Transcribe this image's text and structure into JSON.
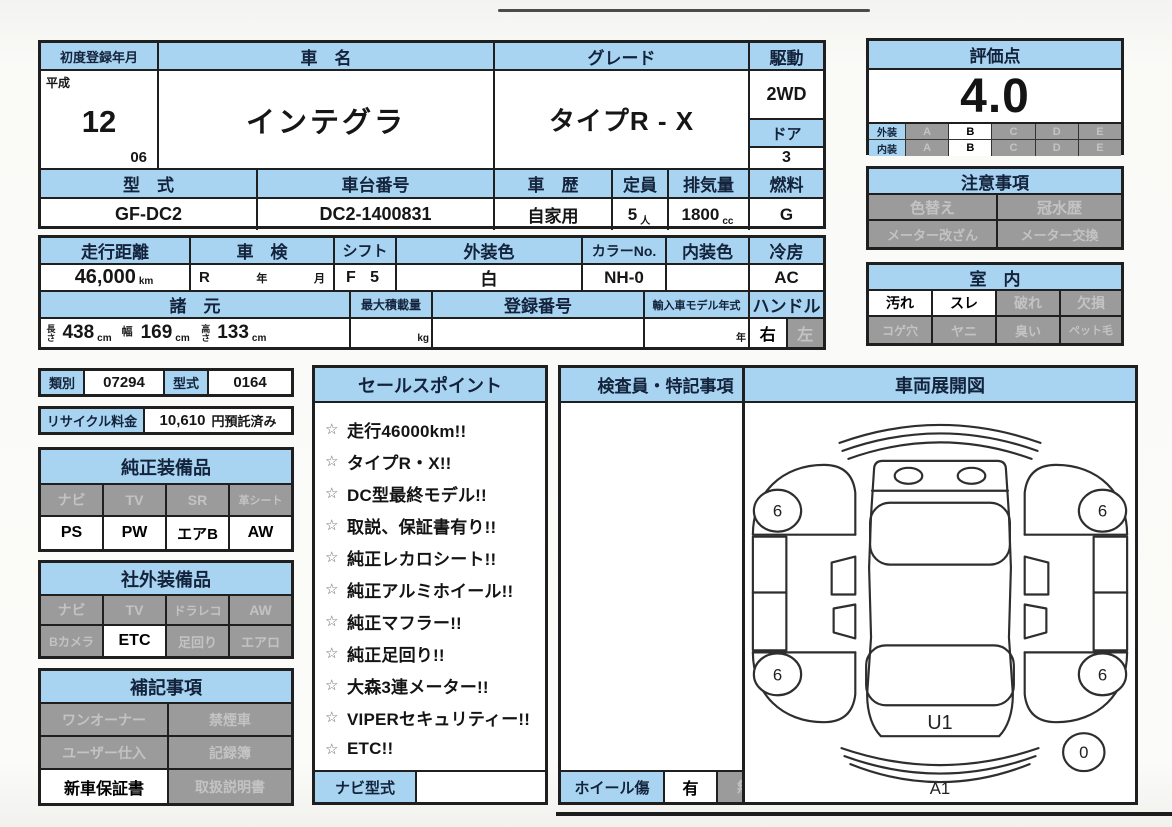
{
  "registration": {
    "label": "初度登録年月",
    "era": "平成",
    "year": "12",
    "month": "06"
  },
  "car_name": {
    "label": "車　名",
    "value": "インテグラ"
  },
  "grade": {
    "label": "グレード",
    "value": "タイプR - X"
  },
  "drive": {
    "label": "駆動",
    "value": "2WD"
  },
  "door": {
    "label": "ドア",
    "value": "3"
  },
  "model_code": {
    "label": "型　式",
    "value": "GF-DC2"
  },
  "chassis_no": {
    "label": "車台番号",
    "value": "DC2-1400831"
  },
  "history": {
    "label": "車　歴",
    "value": "自家用"
  },
  "capacity": {
    "label": "定員",
    "value": "5",
    "unit": "人"
  },
  "displacement": {
    "label": "排気量",
    "value": "1800",
    "unit": "cc"
  },
  "fuel": {
    "label": "燃料",
    "value": "G"
  },
  "score": {
    "label": "評価点",
    "value": "4.0",
    "grades": [
      "A",
      "B",
      "C",
      "D",
      "E"
    ],
    "exterior_label": "外装",
    "interior_label": "内装",
    "exterior_selected": "B",
    "interior_selected": "B"
  },
  "caution": {
    "label": "注意事項",
    "items": [
      "色替え",
      "冠水歴",
      "メーター改ざん",
      "メーター交換"
    ]
  },
  "room": {
    "label": "室　内",
    "items": [
      {
        "label": "汚れ",
        "active": true
      },
      {
        "label": "スレ",
        "active": true
      },
      {
        "label": "破れ",
        "active": false
      },
      {
        "label": "欠損",
        "active": false
      },
      {
        "label": "コゲ穴",
        "active": false
      },
      {
        "label": "ヤニ",
        "active": false
      },
      {
        "label": "臭い",
        "active": false
      },
      {
        "label": "ペット毛",
        "active": false
      }
    ]
  },
  "mileage": {
    "label": "走行距離",
    "value": "46,000",
    "unit": "km"
  },
  "inspection": {
    "label": "車　検",
    "era": "R",
    "year_unit": "年",
    "month_unit": "月"
  },
  "shift": {
    "label": "シフト",
    "value": "F 5"
  },
  "exterior_color": {
    "label": "外装色",
    "value": "白"
  },
  "color_no": {
    "label": "カラーNo.",
    "value": "NH-0"
  },
  "interior_color": {
    "label": "内装色",
    "value": ""
  },
  "cooling": {
    "label": "冷房",
    "value": "AC"
  },
  "spec": {
    "label": "諸　元",
    "length_label": "長さ",
    "length": "438",
    "width_label": "幅",
    "width": "169",
    "height_label": "高さ",
    "height": "133",
    "unit": "cm"
  },
  "max_load": {
    "label": "最大積載量",
    "unit": "kg"
  },
  "reg_number": {
    "label": "登録番号",
    "value": ""
  },
  "import_year": {
    "label": "輸入車モデル年式",
    "unit": "年"
  },
  "steering": {
    "label": "ハンドル",
    "options": [
      {
        "label": "右",
        "active": true
      },
      {
        "label": "左",
        "active": false
      }
    ]
  },
  "category": {
    "label": "類別",
    "value": "07294"
  },
  "type_no": {
    "label": "型式",
    "value": "0164"
  },
  "recycle": {
    "label": "リサイクル料金",
    "value": "10,610",
    "suffix": "円預託済み"
  },
  "oem": {
    "label": "純正装備品",
    "items": [
      {
        "label": "ナビ",
        "active": false
      },
      {
        "label": "TV",
        "active": false
      },
      {
        "label": "SR",
        "active": false
      },
      {
        "label": "革シート",
        "active": false
      },
      {
        "label": "PS",
        "active": true
      },
      {
        "label": "PW",
        "active": true
      },
      {
        "label": "エアB",
        "active": true
      },
      {
        "label": "AW",
        "active": true
      }
    ]
  },
  "aftermarket": {
    "label": "社外装備品",
    "items": [
      {
        "label": "ナビ",
        "active": false
      },
      {
        "label": "TV",
        "active": false
      },
      {
        "label": "ドラレコ",
        "active": false
      },
      {
        "label": "AW",
        "active": false
      },
      {
        "label": "Bカメラ",
        "active": false
      },
      {
        "label": "ETC",
        "active": true
      },
      {
        "label": "足回り",
        "active": false
      },
      {
        "label": "エアロ",
        "active": false
      }
    ]
  },
  "notes": {
    "label": "補記事項",
    "items": [
      {
        "label": "ワンオーナー",
        "active": false
      },
      {
        "label": "禁煙車",
        "active": false
      },
      {
        "label": "ユーザー仕入",
        "active": false
      },
      {
        "label": "記録簿",
        "active": false
      },
      {
        "label": "新車保証書",
        "active": true
      },
      {
        "label": "取扱説明書",
        "active": false
      }
    ]
  },
  "sales": {
    "label": "セールスポイント",
    "bullet": "☆",
    "items": [
      "走行46000km!!",
      "タイプR・X!!",
      "DC型最終モデル!!",
      "取説、保証書有り!!",
      "純正レカロシート!!",
      "純正アルミホイール!!",
      "純正マフラー!!",
      "純正足回り!!",
      "大森3連メーター!!",
      "VIPERセキュリティー!!",
      "ETC!!"
    ],
    "navi_label": "ナビ型式",
    "navi_value": ""
  },
  "inspector": {
    "label": "検査員・特記事項",
    "body": ""
  },
  "wheel_damage": {
    "label": "ホイール傷",
    "options": [
      {
        "label": "有",
        "active": true
      },
      {
        "label": "無",
        "active": false
      }
    ]
  },
  "diagram": {
    "label": "車両展開図",
    "wheels": [
      "6",
      "6",
      "6",
      "6"
    ],
    "rear": "U1",
    "bottom": "A1",
    "spare": "0"
  }
}
